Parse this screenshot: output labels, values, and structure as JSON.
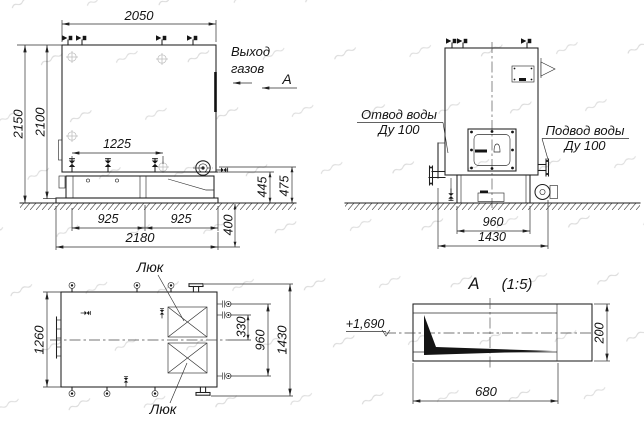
{
  "meta": {
    "background": "#ffffff",
    "line_color": "#1f1f1f",
    "drawing_type": "boiler installation drawing"
  },
  "side_view": {
    "dim_width_top": "2050",
    "dim_height_total": "2150",
    "dim_height_body": "2100",
    "dim_valve_span": "1225",
    "dim_base_left": "925",
    "dim_base_right": "925",
    "dim_base_total": "2180",
    "dim_pit_depth": "400",
    "dim_base_h_inner": "445",
    "dim_base_h_outer": "475",
    "label_gas_out_l1": "Выход",
    "label_gas_out_l2": "газов",
    "label_section": "А"
  },
  "front_view": {
    "dim_base_width": "960",
    "dim_overall_width": "1430",
    "label_outlet_l1": "Отвод воды",
    "label_outlet_l2": "Ду 100",
    "label_inlet_l1": "Подвод воды",
    "label_inlet_l2": "Ду 100"
  },
  "top_view": {
    "dim_width": "1260",
    "dim_nozzle_gap": "330",
    "dim_nozzle_span": "960",
    "dim_overall": "1430",
    "label_hatch_top": "Люк",
    "label_hatch_bottom": "Люк"
  },
  "detail_a": {
    "title": "А",
    "scale": "(1:5)",
    "elevation": "+1,690",
    "dim_length": "680",
    "dim_height": "200"
  }
}
